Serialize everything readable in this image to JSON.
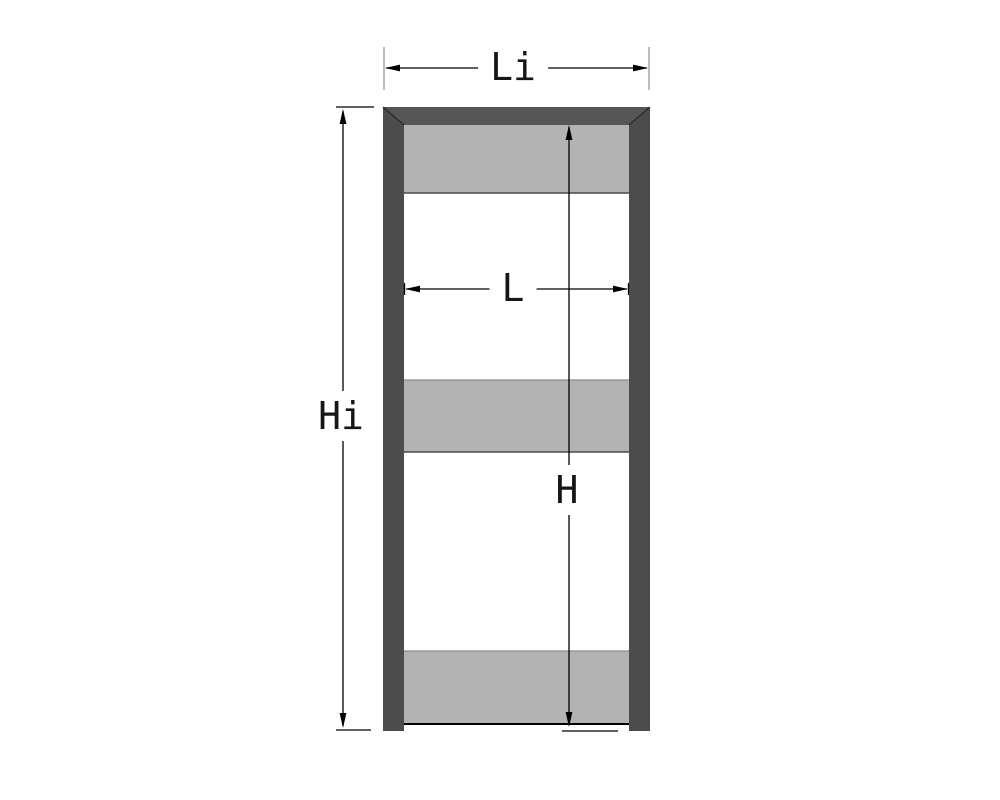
{
  "figure": {
    "description": "Frame profile drawing with three shaded panel bands and four dimension callouts"
  },
  "labels": {
    "outer_width": "Li",
    "inner_width": "L",
    "outer_height": "Hi",
    "inner_height": "H"
  },
  "colors": {
    "background": "#ffffff",
    "frame": "#4c4c4c",
    "frame_head": "#565656",
    "frame_seam": "#2d2d2d",
    "panel": "#b3b3b3",
    "panel_edge_top": "#8a8a8a",
    "panel_edge_bottom": "#4a4a4a",
    "sill_line": "#000000",
    "dimension": "#000000",
    "extension_tick": "#999999",
    "label_ink": "#161616"
  }
}
